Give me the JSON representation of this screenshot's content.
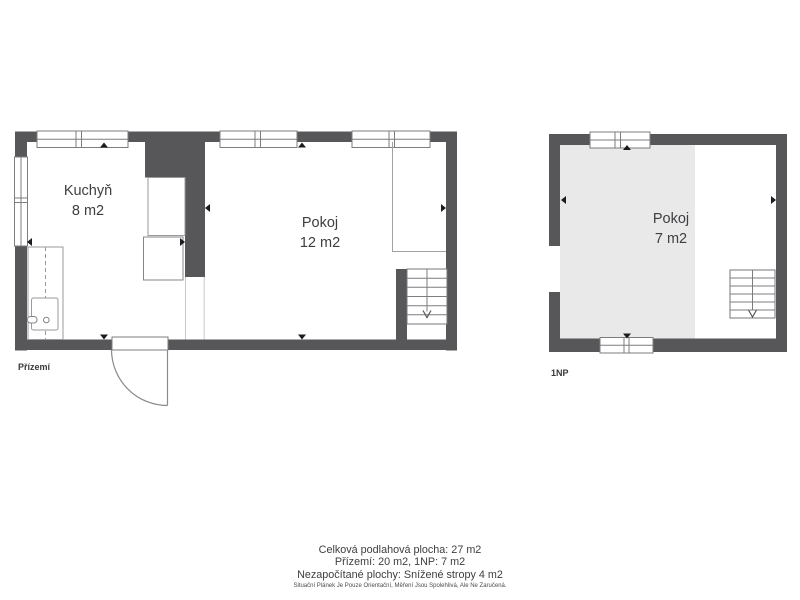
{
  "plans": {
    "ground": {
      "label": "Přízemí",
      "rooms": [
        {
          "name": "Kuchyň",
          "area": "8 m2"
        },
        {
          "name": "Pokoj",
          "area": "12 m2"
        }
      ]
    },
    "upper": {
      "label": "1NP",
      "rooms": [
        {
          "name": "Pokoj",
          "area": "7 m2"
        }
      ]
    }
  },
  "footer": {
    "total": "Celková podlahová plocha: 27 m2",
    "per_floor": "Přízemí: 20 m2, 1NP: 7 m2",
    "excluded": "Nezapočítané plochy: Snížené stropy 4 m2",
    "disclaimer": "Situační Plánek Je Pouze Orientační, Měření Jsou Spolehlivá, Ale Ne Zaručená."
  },
  "colors": {
    "wall": "#57575a",
    "shade": "#e9e9ea",
    "text": "#3e3e40"
  }
}
